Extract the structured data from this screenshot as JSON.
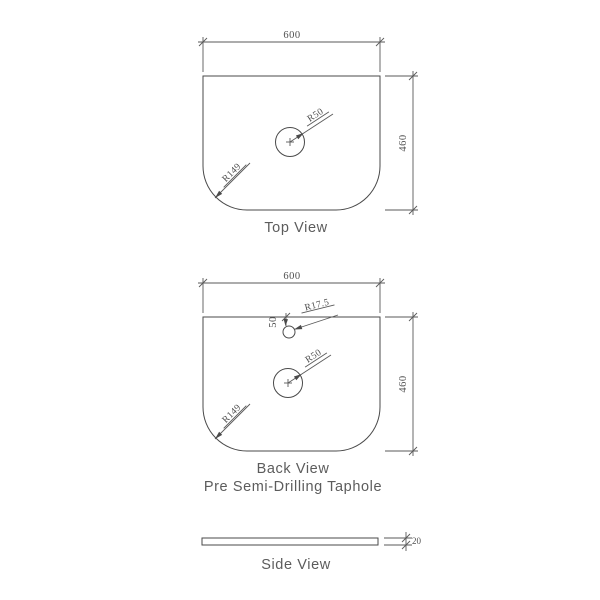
{
  "colors": {
    "background": "#ffffff",
    "line": "#4a4a4a",
    "dimension_text": "#4f4f4f",
    "label_text": "#5c5c5c"
  },
  "views": {
    "top": {
      "label": "Top View",
      "width_dim": "600",
      "height_dim": "460",
      "hole_radius": "R50",
      "corner_radius": "R149"
    },
    "back": {
      "label": "Back View",
      "sublabel": "Pre Semi-Drilling Taphole",
      "width_dim": "600",
      "height_dim": "460",
      "hole_radius": "R50",
      "corner_radius": "R149",
      "taphole_radius": "R17.5",
      "taphole_offset": "50"
    },
    "side": {
      "label": "Side View",
      "thickness_dim": "20"
    }
  }
}
